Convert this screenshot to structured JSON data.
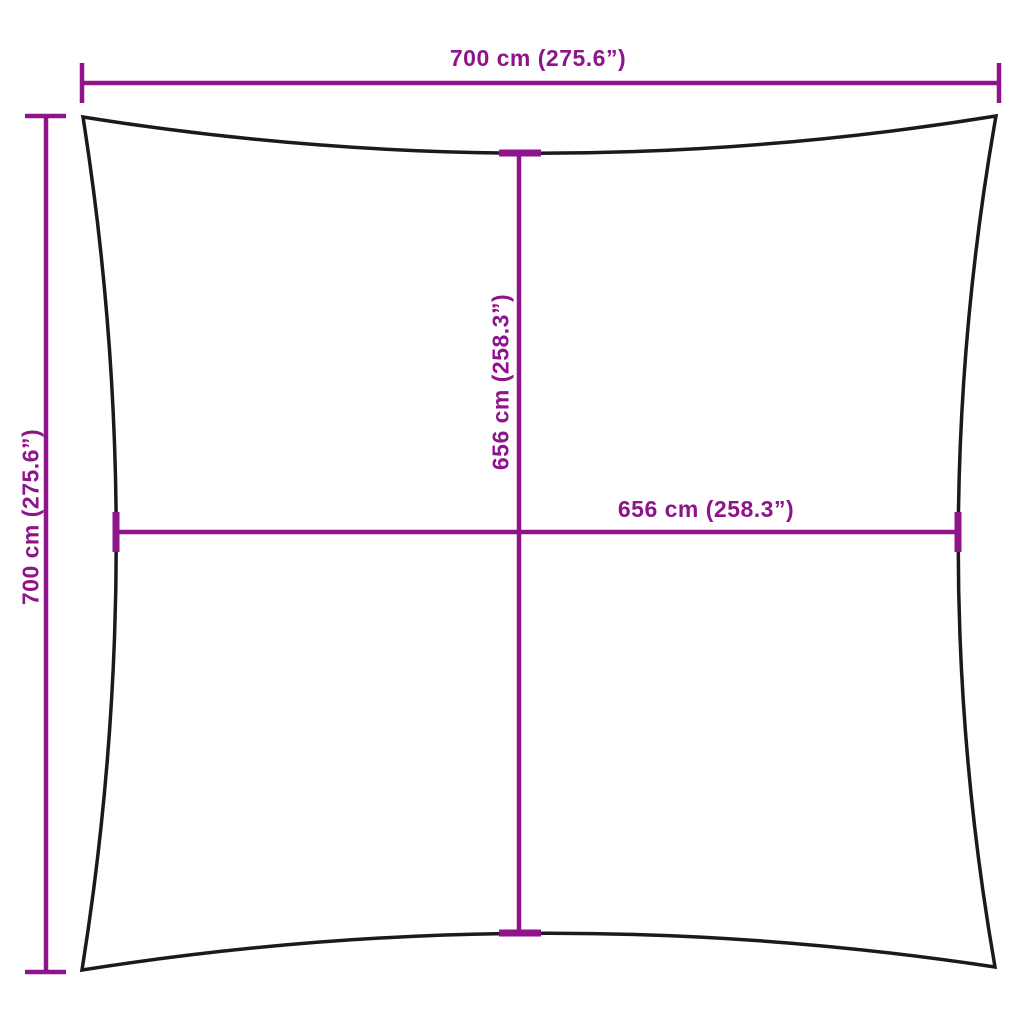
{
  "diagram": {
    "colors": {
      "dimension": "#8F148C",
      "outline": "#1A1A1A",
      "background": "#FFFFFF"
    },
    "labels": {
      "outer_width": "700 cm (275.6”)",
      "outer_height": "700 cm (275.6”)",
      "inner_width": "656 cm (258.3”)",
      "inner_height": "656 cm (258.3”)"
    }
  }
}
